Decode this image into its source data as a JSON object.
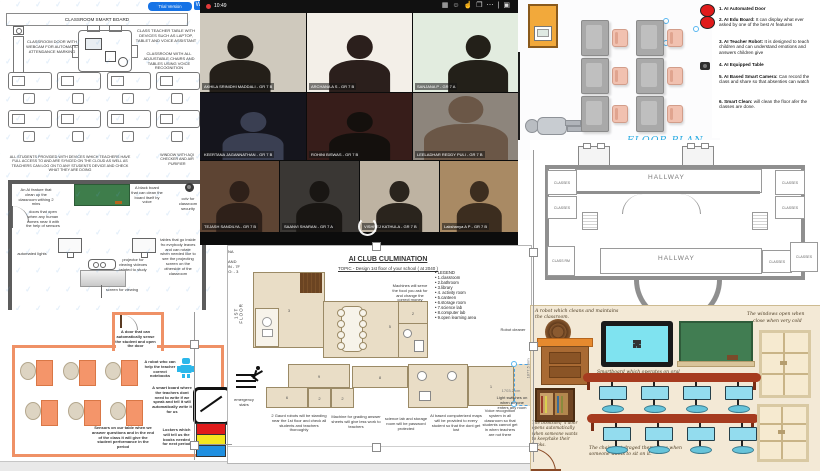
{
  "whiteboard": {
    "trial_badge": "Trial Version",
    "brand_initial": "W",
    "title": "CLASSROOM SMART BOARD",
    "door_label": "CLASSROOM DOOR WITH WEBCAM FOR AUTOMATIC ATTENDANCE MARKING",
    "teacher_table_label": "CLASS TEACHER TABLE WITH DEVICES SUCH AS LAPTOP, TABLET AND VOICE ASSISTANT",
    "adjustable_label": "CLASSROOM WITH ALL ADJUSTABLE CHAIRS AND TABLES USING VOICE RECOGNITION",
    "devices_note": "ALL STUDENTS PROVIDED WITH DEVICES WHICH TEACHERS HAVE FULL ACCESS TO AND ARE SYNCED ON THE CLOUD AS WELL AS TEACHERS CAN LOG ON TO ANY STUDENTS DEVICE AND CHECK WHAT THEY ARE DOING",
    "window_note": "WINDOW WITH AQI CHECKER AND AIR PURIFIER",
    "room": {
      "cleanup": "An AI feature that clean up the classroom withing 2 mins",
      "board": "A black board that can clean the board itself by voice",
      "cctv": "cctv for classroom security",
      "doors": "doors that open when any human comes near it with the help of sensors",
      "lights": "automated lights",
      "projector": "projector for viewing videoes related to study",
      "screen": "screen for viewing",
      "tables": "tables that go inside fro evrybody leaves and can rotate when needed like to see the projecting screen on the otherside of the classroom"
    }
  },
  "video_call": {
    "time": "10:49",
    "participants": [
      "AKHILA SRINIDHI MADDALI - GR 7 B",
      "ARCHANA A S - GR 7 B",
      "SANJANA P - GR 7 A",
      "KEERTANA JAGANNATHAN - GR 7 B",
      "ROHINI BISWAS - GR 7 B",
      "LEELADHAR REDDY PULI - GR 7 B",
      "TEJASH SANDILYA - GR 7 B",
      "SAANVI SHARAN - GR 7 A",
      "VISHREJ KATHULA - GR 7 B",
      "Lakshanya A P - GR 7 B"
    ]
  },
  "floor_plan": {
    "caption": "FLOOR PLAN"
  },
  "features": {
    "items": [
      {
        "lead": "1. AI Automated Door",
        "rest": ""
      },
      {
        "lead": "2. AI Edu Board:",
        "rest": " It can display what ever asked by one of the best AI features"
      },
      {
        "lead": "3. AI Teacher Robot:",
        "rest": " It is designed to teach children and can understand emotions and answers children give"
      },
      {
        "lead": "4. AI Equipped Table",
        "rest": ""
      },
      {
        "lead": "5. AI Based Smart Camera:",
        "rest": " Can record the class and share so that absenties can watch"
      },
      {
        "lead": "6. Smart Clean:",
        "rest": " will clean the floor afer the classes are done."
      }
    ]
  },
  "hallway": {
    "top_label": "HALLWAY",
    "bottom_label": "HALLWAY",
    "rooms": {
      "left1": "CLASSES",
      "left2": "CLASSES",
      "right1": "CLASSES",
      "right2": "CLASSES",
      "bottom_left": "CLASS RM",
      "bottom_right1": "CLASSES",
      "bottom_right2": "CLASSES"
    }
  },
  "orange_room": {
    "door_note": "A door that can automatically sense the student and open the door",
    "robot_note": "A robot who can help the teacher correct notebooks",
    "board_note": "A smart board where the teachers dont need to write if we speak and tell it will automatically write it for us",
    "sensors_note": "Sensors on our table when we answer questions and in the end of the class it will give the student performance in the period",
    "lockers_note": "Lockers which will tell us the books needed for next period"
  },
  "culmination": {
    "title": "AI CLUB CULMINATION",
    "topic": "TOPIC - Design 1st floor of your school ( at 2040 )",
    "student_lines": [
      "ARCHANA",
      "A S",
      "CLASS AND",
      "SECTION - 7F",
      "ROLL NO: - 3"
    ],
    "floor_label": "1ST FLOOR",
    "legend": [
      "LEGEND",
      "1.classroom",
      "2.bathroom",
      "3.library",
      "4. activity room",
      "5.canteen",
      "6.storage room",
      "7.science lab",
      "8.computer lab",
      "9.open learning area"
    ],
    "canteen_note": "Machines will serve the food you ask for and change the correct money",
    "robot_note": "Robot cleaner",
    "emergency": "emergency stairs",
    "notes": {
      "guards": "2 Gaurd robots will be standing near the 1st floor and check all students and teachers thoroughly",
      "grading": "Machine for grading answer sheets will give less work to teachers",
      "science": "science lab and storage room will be password protected",
      "maps": "AI based computerized maps will be provided to every student so that the dont get lost",
      "voice": "Voice recognition system in all classroom so that students cannot get in when teachers are not there",
      "lights": "Light switches on when anyone enters any room"
    },
    "rooms": {
      "library": "3",
      "canteen": "5",
      "bath_top": "2",
      "band9": "9",
      "band8": "8",
      "band6": "6",
      "band2a": "2",
      "band2b": "2",
      "band1a": "1",
      "band1b": "1",
      "band1c": "1"
    },
    "dims": {
      "h": "1703.2 cm",
      "v": "1877.5 mm"
    }
  },
  "illustration": {
    "robot_note": "A robot which cleans and maintains the classroom.",
    "smartboard_note": "Smartboard which operates on oral instructions.",
    "windows_note_1": "The windows open when",
    "windows_note_2": "close when very cold",
    "bookshelf_note": "The bookshelf 's door opens automatically when someone wants to keep/take their books.",
    "chairs_note": "The chairs get draged themselves when someone wants to sit on it."
  },
  "colors": {
    "accent_blue": "#29abe2",
    "locker_red": "#e01b1b",
    "locker_yellow": "#f4e61f",
    "locker_blue": "#1f8fe0",
    "desk_orange": "#f4956a",
    "robot_blue": "#2bb7ea"
  }
}
